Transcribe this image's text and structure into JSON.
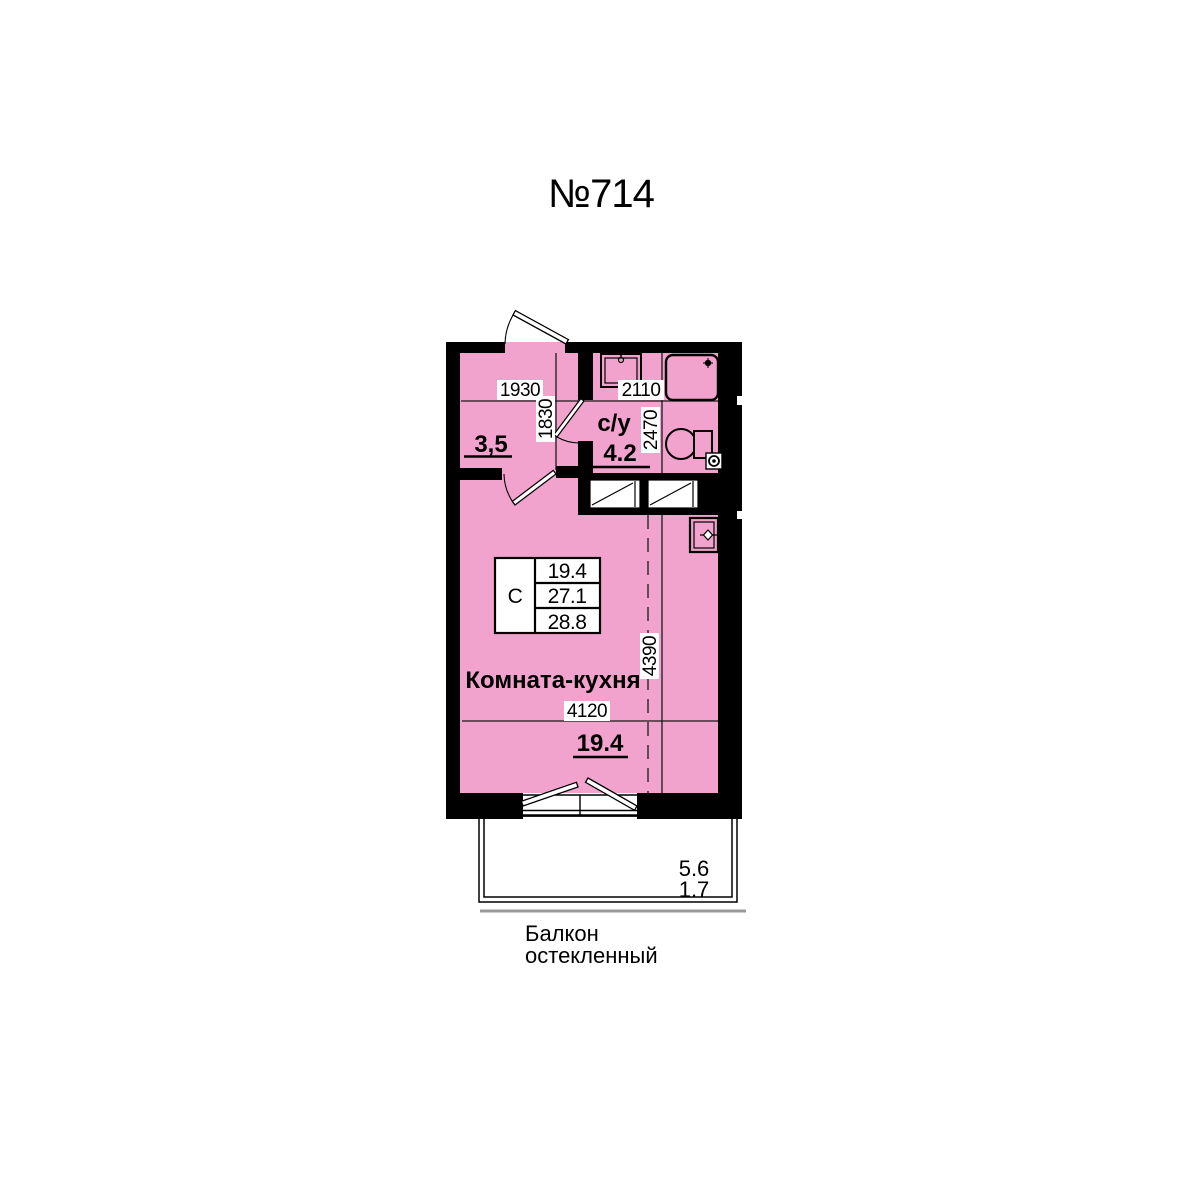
{
  "title": "№714",
  "colors": {
    "room_fill": "#F1A3CE",
    "wall": "#000000",
    "balcony_line": "#9A9A9A"
  },
  "labels": {
    "hallway_area": "3,5",
    "bathroom_name": "с/у",
    "bathroom_area": "4.2",
    "room_name": "Комната-кухня",
    "room_area": "19.4",
    "balcony_word1": "Балкон",
    "balcony_word2": "остекленный",
    "balcony_area_total": "5.6",
    "balcony_area_reduced": "1.7"
  },
  "info_box": {
    "type": "С",
    "living_area": "19.4",
    "area_no_balcony": "27.1",
    "total_area": "28.8"
  },
  "dimensions": {
    "hallway_width_mm": "1930",
    "hallway_depth_mm": "1830",
    "bathroom_width_mm": "2110",
    "bathroom_depth_mm": "2470",
    "room_depth_mm": "4390",
    "room_width_mm": "4120"
  }
}
